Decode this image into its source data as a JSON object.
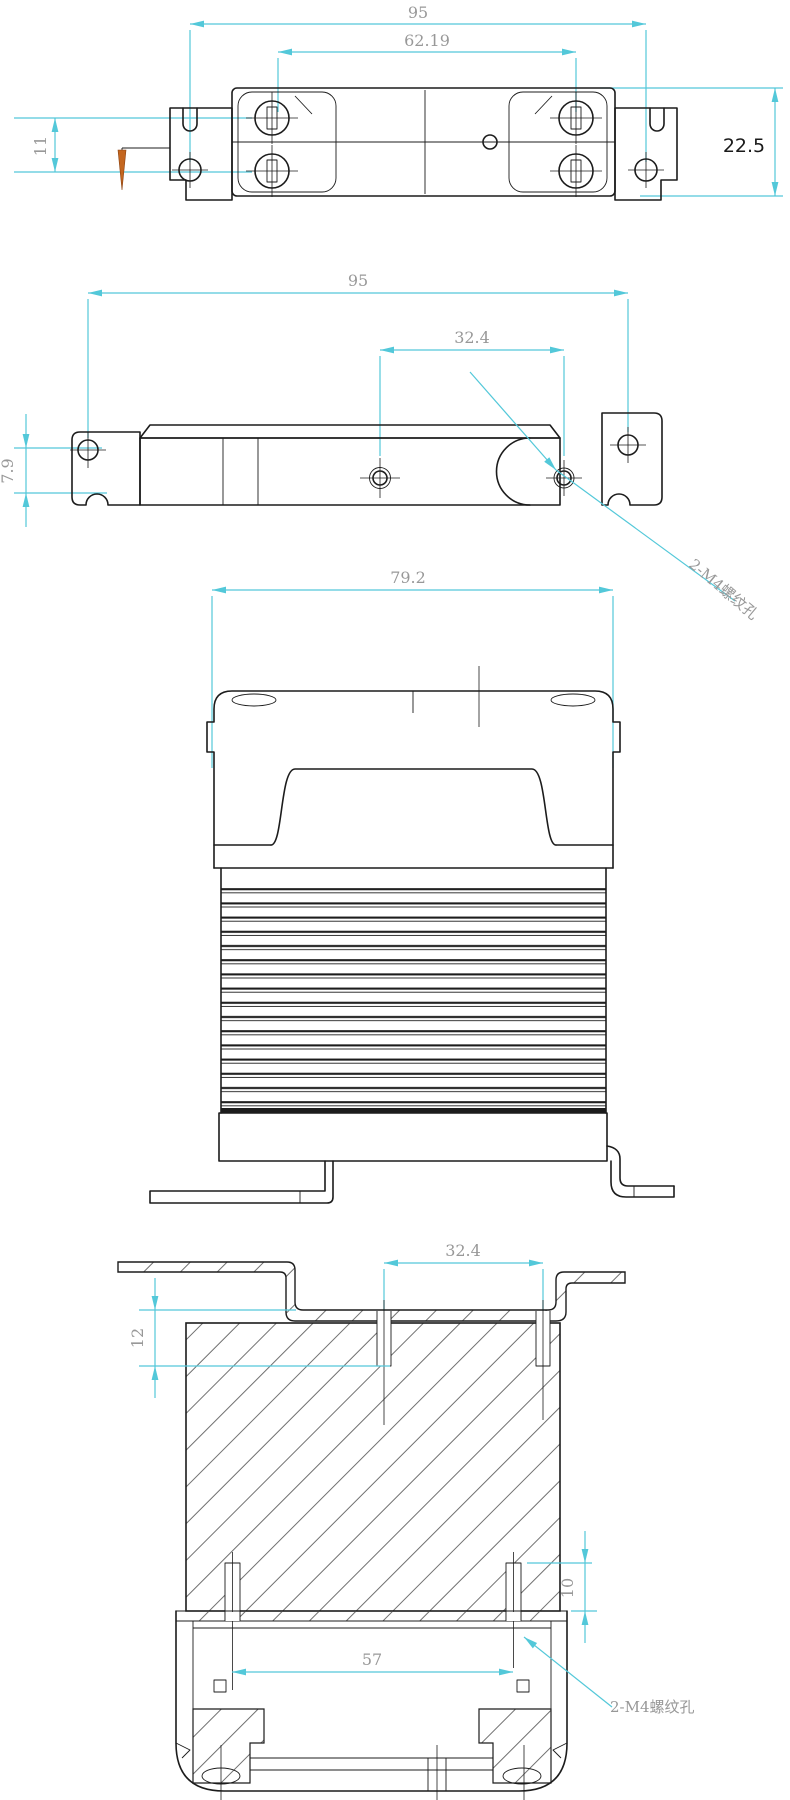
{
  "drawing": {
    "type": "engineering-multiview",
    "colors": {
      "outline": "#1c1c1c",
      "dimension_line": "#53c8d9",
      "dimension_text": "#989898",
      "highlight_text": "#1a1a1a",
      "cursor_orange": "#c4661f",
      "background": "#ffffff"
    },
    "top_view": {
      "width": "95",
      "terminal_pitch": "62.19",
      "row_pitch": "11",
      "height": "22.5"
    },
    "bottom_view": {
      "width": "95",
      "hole_pitch": "32.4",
      "hole_offset": "7.9",
      "thread_label": "2-M4螺纹孔"
    },
    "front_view": {
      "width": "79.2"
    },
    "section_view": {
      "hole_pitch": "32.4",
      "thread_depth_top": "12",
      "thread_depth_bottom": "10",
      "terminal_pitch": "57",
      "thread_label": "2-M4螺纹孔"
    }
  }
}
